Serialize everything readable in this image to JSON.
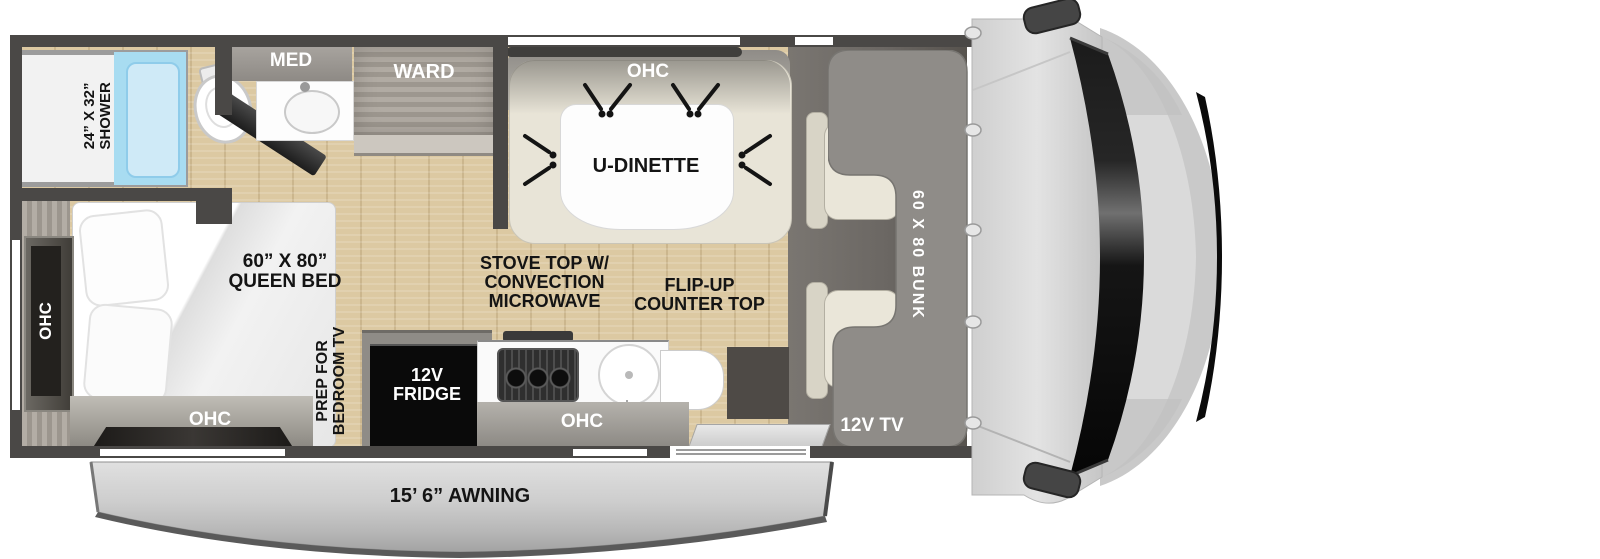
{
  "colors": {
    "wall": "#4a4846",
    "wood": "#dcc9a2",
    "wood_dark": "#cbb68d",
    "cab_floor": "#6b6763",
    "bunk": "#8f8c88",
    "shower_blue": "#a8dcf1",
    "bench": "#e8e4d7",
    "awning_gray": "#c9c9c9",
    "label_dark": "#141414",
    "label_light": "#ffffff"
  },
  "bathroom": {
    "shower_size": "24” X 32”",
    "shower_name": "SHOWER",
    "med": "MED",
    "ward": "WARD"
  },
  "dinette": {
    "ohc": "OHC",
    "table": "U-DINETTE"
  },
  "bedroom": {
    "bed_size": "60” X 80”",
    "bed_name": "QUEEN BED",
    "ohc_side": "OHC",
    "ohc_foot": "OHC",
    "tv_prep_1": "PREP FOR",
    "tv_prep_2": "BEDROOM TV"
  },
  "kitchen": {
    "stove_1": "STOVE TOP W/",
    "stove_2": "CONVECTION",
    "stove_3": "MICROWAVE",
    "flip_1": "FLIP-UP",
    "flip_2": "COUNTER TOP",
    "fridge_1": "12V",
    "fridge_2": "FRIDGE",
    "ohc": "OHC"
  },
  "cab": {
    "bunk": "60 X 80 BUNK",
    "tv": "12V TV"
  },
  "exterior": {
    "awning": "15’ 6” AWNING"
  }
}
